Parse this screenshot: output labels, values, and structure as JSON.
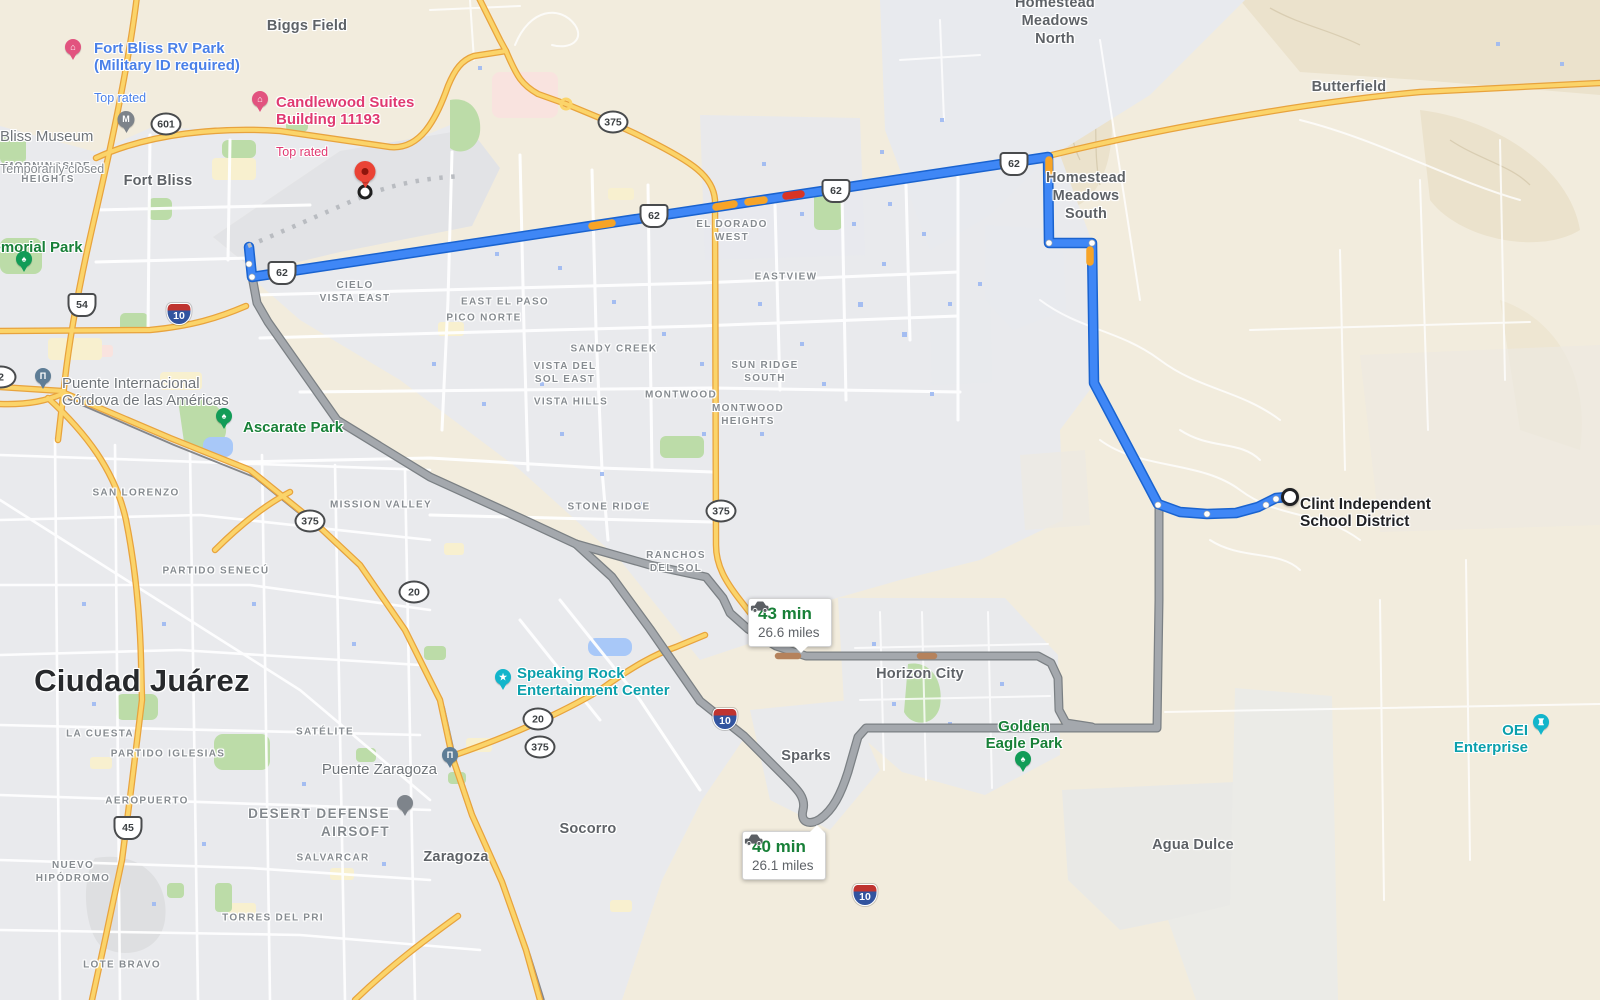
{
  "map": {
    "city_labels": [
      {
        "name": "label-biggs-field",
        "text": "Biggs Field",
        "x": 307,
        "y": 26
      },
      {
        "name": "label-fort-bliss",
        "text": "Fort Bliss",
        "x": 158,
        "y": 181
      },
      {
        "name": "label-butterfield",
        "text": "Butterfield",
        "x": 1349,
        "y": 87
      },
      {
        "name": "label-homestead-meadows-north",
        "text": "Homestead\nMeadows\nNorth",
        "x": 1055,
        "y": 21
      },
      {
        "name": "label-homestead-meadows-south",
        "text": "Homestead\nMeadows\nSouth",
        "x": 1086,
        "y": 196
      },
      {
        "name": "label-horizon-city",
        "text": "Horizon City",
        "x": 920,
        "y": 674
      },
      {
        "name": "label-sparks",
        "text": "Sparks",
        "x": 806,
        "y": 756
      },
      {
        "name": "label-socorro",
        "text": "Socorro",
        "x": 588,
        "y": 829
      },
      {
        "name": "label-zaragoza",
        "text": "Zaragoza",
        "x": 456,
        "y": 857
      },
      {
        "name": "label-agua-dulce",
        "text": "Agua Dulce",
        "x": 1193,
        "y": 845
      },
      {
        "name": "label-ciudad-juarez",
        "text": "Ciudad Juárez",
        "x": 142,
        "y": 681,
        "cls": "city-major"
      }
    ],
    "neighborhood_labels": [
      {
        "name": "label-morningside-heights",
        "text": "MORNINGSIDE\nHEIGHTS",
        "x": 48,
        "y": 173
      },
      {
        "name": "label-cielo-vista-east",
        "text": "CIELO\nVISTA EAST",
        "x": 355,
        "y": 292
      },
      {
        "name": "label-east-el-paso",
        "text": "EAST EL PASO",
        "x": 505,
        "y": 302
      },
      {
        "name": "label-pico-norte",
        "text": "PICO NORTE",
        "x": 484,
        "y": 318
      },
      {
        "name": "label-sandy-creek",
        "text": "SANDY CREEK",
        "x": 614,
        "y": 349
      },
      {
        "name": "label-vista-del-sol-east",
        "text": "VISTA DEL\nSOL EAST",
        "x": 565,
        "y": 373
      },
      {
        "name": "label-vista-hills",
        "text": "VISTA HILLS",
        "x": 571,
        "y": 402
      },
      {
        "name": "label-montwood",
        "text": "MONTWOOD",
        "x": 681,
        "y": 395
      },
      {
        "name": "label-montwood-heights",
        "text": "MONTWOOD\nHEIGHTS",
        "x": 748,
        "y": 415
      },
      {
        "name": "label-sun-ridge-south",
        "text": "SUN RIDGE\nSOUTH",
        "x": 765,
        "y": 372
      },
      {
        "name": "label-eastview",
        "text": "EASTVIEW",
        "x": 786,
        "y": 277
      },
      {
        "name": "label-el-dorado-west",
        "text": "EL DORADO\nWEST",
        "x": 732,
        "y": 231
      },
      {
        "name": "label-stone-ridge",
        "text": "STONE RIDGE",
        "x": 609,
        "y": 507
      },
      {
        "name": "label-ranchos-del-sol",
        "text": "RANCHOS\nDEL SOL",
        "x": 676,
        "y": 562
      },
      {
        "name": "label-mission-valley",
        "text": "MISSION VALLEY",
        "x": 381,
        "y": 505
      },
      {
        "name": "label-san-lorenzo",
        "text": "SAN LORENZO",
        "x": 136,
        "y": 493
      },
      {
        "name": "label-partido-senecu",
        "text": "PARTIDO SENECÚ",
        "x": 216,
        "y": 571
      },
      {
        "name": "label-la-cuesta",
        "text": "LA CUESTA",
        "x": 100,
        "y": 734
      },
      {
        "name": "label-partido-iglesias",
        "text": "PARTIDO IGLESIAS",
        "x": 168,
        "y": 754
      },
      {
        "name": "label-satelite",
        "text": "SATÉLITE",
        "x": 325,
        "y": 732
      },
      {
        "name": "label-aeropuerto",
        "text": "AEROPUERTO",
        "x": 147,
        "y": 801
      },
      {
        "name": "label-salvarcar",
        "text": "SALVARCAR",
        "x": 333,
        "y": 858
      },
      {
        "name": "label-nuevo-hipodromo",
        "text": "NUEVO\nHIPÓDROMO",
        "x": 73,
        "y": 872
      },
      {
        "name": "label-torres-del-pri",
        "text": "TORRES DEL PRI",
        "x": 273,
        "y": 918
      },
      {
        "name": "label-lote-bravo",
        "text": "LOTE BRAVO",
        "x": 122,
        "y": 965
      }
    ],
    "poi_labels": [
      {
        "name": "label-fort-bliss-rv-park",
        "text": "Fort Bliss RV Park\n(Military ID required)",
        "sub": "Top rated",
        "x": 94,
        "y": 23,
        "cls": "c-blue"
      },
      {
        "name": "label-candlewood-suites",
        "text": "Candlewood Suites\nBuilding 11193",
        "sub": "Top rated",
        "x": 276,
        "y": 77,
        "cls": "c-pink"
      },
      {
        "name": "label-bliss-museum",
        "text": "Bliss Museum",
        "sub": "Temporarily closed",
        "x": 0,
        "y": 111,
        "cls": "c-gray"
      },
      {
        "name": "label-memorial-park",
        "text": "Memorial Park",
        "x": -20,
        "y": 222,
        "cls": "c-green"
      },
      {
        "name": "label-puente-internacional",
        "text": "Puente Internacional\nCórdova de las Américas",
        "x": 62,
        "y": 358,
        "cls": "c-gray"
      },
      {
        "name": "label-ascarate-park",
        "text": "Ascarate Park",
        "x": 243,
        "y": 402,
        "cls": "c-green"
      },
      {
        "name": "label-speaking-rock",
        "text": "Speaking Rock\nEntertainment Center",
        "x": 517,
        "y": 648,
        "cls": "c-teal"
      },
      {
        "name": "label-golden-eagle-park",
        "text": "Golden\nEagle Park",
        "x": 1024,
        "y": 701,
        "cls": "c-green anchor-c"
      },
      {
        "name": "label-oei-enterprise",
        "text": "OEI Enterprise",
        "x": 1528,
        "y": 705,
        "cls": "c-teal anchor-r"
      },
      {
        "name": "label-puente-zaragoza",
        "text": "Puente Zaragoza",
        "x": 437,
        "y": 744,
        "cls": "c-gray anchor-r"
      },
      {
        "name": "label-desert-defense-airsoft",
        "text": "DESERT DEFENSE\nAIRSOFT",
        "x": 390,
        "y": 787,
        "cls": "caps-md anchor-r"
      },
      {
        "name": "label-clint-isd",
        "text": "Clint Independent\nSchool District",
        "x": 1300,
        "y": 478,
        "cls": "c-dark"
      }
    ],
    "shields": [
      {
        "name": "shield-loop-601",
        "label": "601",
        "x": 166,
        "y": 124,
        "cls": "shield-loop"
      },
      {
        "name": "shield-loop-375-a",
        "label": "375",
        "x": 613,
        "y": 122,
        "cls": "shield-loop"
      },
      {
        "name": "shield-loop-375-b",
        "label": "375",
        "x": 310,
        "y": 521,
        "cls": "shield-loop"
      },
      {
        "name": "shield-loop-375-c",
        "label": "375",
        "x": 721,
        "y": 511,
        "cls": "shield-loop"
      },
      {
        "name": "shield-loop-375-d",
        "label": "375",
        "x": 540,
        "y": 747,
        "cls": "shield-loop"
      },
      {
        "name": "shield-loop-20-a",
        "label": "20",
        "x": 414,
        "y": 592,
        "cls": "shield-loop"
      },
      {
        "name": "shield-loop-20-b",
        "label": "20",
        "x": 538,
        "y": 719,
        "cls": "shield-loop"
      },
      {
        "name": "shield-loop-2",
        "label": "2",
        "x": 1,
        "y": 377,
        "cls": "shield-loop"
      },
      {
        "name": "shield-us-62-a",
        "label": "62",
        "x": 282,
        "y": 273,
        "cls": "shield-us"
      },
      {
        "name": "shield-us-62-b",
        "label": "62",
        "x": 654,
        "y": 216,
        "cls": "shield-us"
      },
      {
        "name": "shield-us-62-c",
        "label": "62",
        "x": 836,
        "y": 191,
        "cls": "shield-us"
      },
      {
        "name": "shield-us-62-d",
        "label": "62",
        "x": 1014,
        "y": 164,
        "cls": "shield-us"
      },
      {
        "name": "shield-us-54",
        "label": "54",
        "x": 82,
        "y": 305,
        "cls": "shield-us"
      },
      {
        "name": "shield-mx-45",
        "label": "45",
        "x": 128,
        "y": 828,
        "cls": "shield-us"
      },
      {
        "name": "shield-i10-a",
        "label": "10",
        "x": 179,
        "y": 314,
        "cls": "shield-i10"
      },
      {
        "name": "shield-i10-b",
        "label": "10",
        "x": 725,
        "y": 719,
        "cls": "shield-i10"
      },
      {
        "name": "shield-i10-c",
        "label": "10",
        "x": 865,
        "y": 895,
        "cls": "shield-i10"
      }
    ],
    "pins": [
      {
        "name": "hotel-pin-fort-bliss-rv",
        "glyph": "⌂",
        "x": 73,
        "y": 60,
        "cls": "pin-hotel"
      },
      {
        "name": "hotel-pin-candlewood",
        "glyph": "⌂",
        "x": 260,
        "y": 112,
        "cls": "pin-hotel"
      },
      {
        "name": "museum-icon-bliss",
        "glyph": "M",
        "x": 126,
        "y": 133,
        "cls": "pin-museum"
      },
      {
        "name": "park-pin-memorial",
        "glyph": "♠",
        "x": 24,
        "y": 272,
        "cls": "pin-park"
      },
      {
        "name": "bridge-pin-puente-internacional",
        "glyph": "П",
        "x": 43,
        "y": 389,
        "cls": "pin-bridge"
      },
      {
        "name": "park-pin-ascarate",
        "glyph": "♠",
        "x": 224,
        "y": 429,
        "cls": "pin-park"
      },
      {
        "name": "attraction-pin-speaking-rock",
        "glyph": "★",
        "x": 503,
        "y": 690,
        "cls": "pin-teal"
      },
      {
        "name": "park-pin-golden-eagle",
        "glyph": "♠",
        "x": 1023,
        "y": 772,
        "cls": "pin-park"
      },
      {
        "name": "landmark-pin-oei",
        "glyph": "♜",
        "x": 1541,
        "y": 735,
        "cls": "pin-teal"
      },
      {
        "name": "bridge-pin-puente-zaragoza",
        "glyph": "П",
        "x": 450,
        "y": 768,
        "cls": "pin-bridge"
      },
      {
        "name": "place-pin-airsoft",
        "x": 405,
        "y": 816,
        "cls": "pin-gray"
      }
    ],
    "route_bubbles": [
      {
        "name": "route-bubble-43",
        "time": "43 min",
        "dist": "26.6 miles",
        "x": 748,
        "y": 598,
        "cls": "ptr-bottom",
        "px": 52
      },
      {
        "name": "route-bubble-40",
        "time": "40 min",
        "dist": "26.1 miles",
        "x": 742,
        "y": 831,
        "cls": "ptr-top",
        "px": 74
      }
    ]
  }
}
